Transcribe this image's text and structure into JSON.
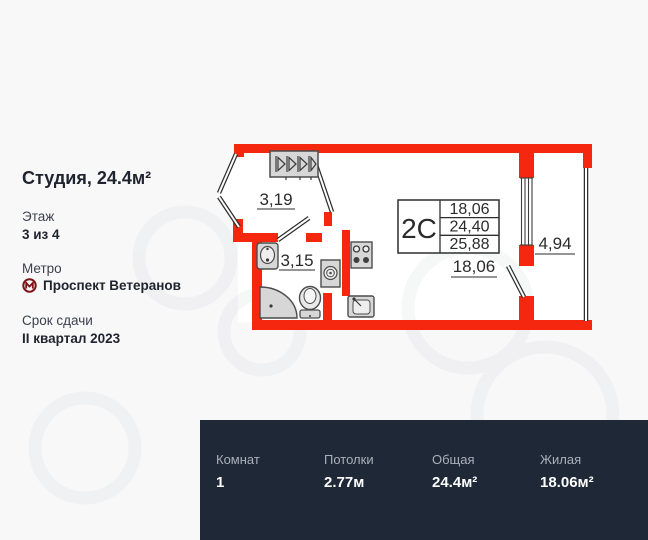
{
  "sidebar": {
    "title": "Студия, 24.4м²",
    "floor_label": "Этаж",
    "floor_value": "3 из 4",
    "metro_label": "Метро",
    "metro_station": "Проспект Ветеранов",
    "metro_icon_color": "#7c1518",
    "deadline_label": "Срок сдачи",
    "deadline_value": "II квартал 2023"
  },
  "floorplan": {
    "wall_color": "#f5270f",
    "labels": {
      "hall_area": "3,19",
      "bathroom_area": "3,15",
      "room_width": "18,06",
      "balcony_area": "4,94"
    },
    "info_table": {
      "type": "2С",
      "values": [
        "18,06",
        "24,40",
        "25,88"
      ]
    }
  },
  "bottom_bar": {
    "bg": "#1e2836",
    "stats": [
      {
        "label": "Комнат",
        "value": "1"
      },
      {
        "label": "Потолки",
        "value": "2.77м"
      },
      {
        "label": "Общая",
        "value": "24.4м²"
      },
      {
        "label": "Жилая",
        "value": "18.06м²"
      }
    ]
  }
}
